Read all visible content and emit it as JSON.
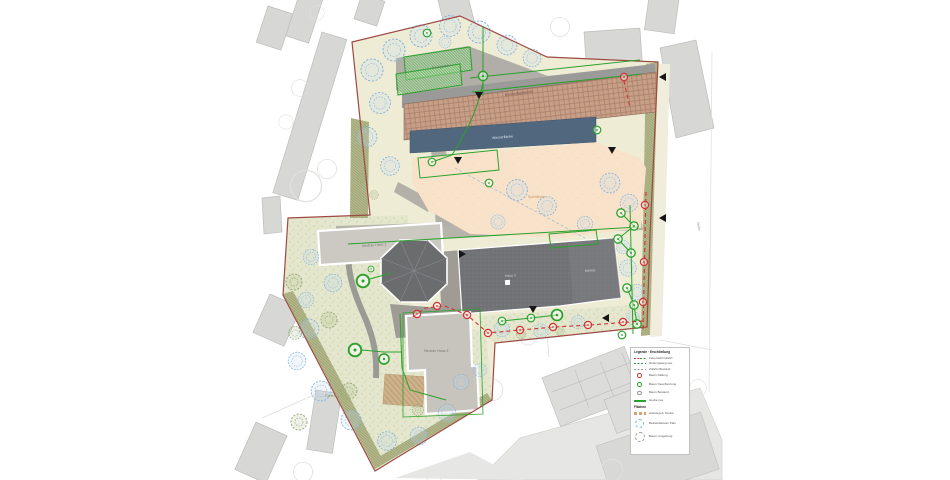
{
  "plan": {
    "labels": {
      "terrace": "Dachgarten",
      "brick_building": "Bestandsgebäude",
      "water": "Wasserfläche",
      "play_area": "Spielfläche",
      "house1": "Neubau Haus 1",
      "house2": "Haus 2",
      "mensa": "Mensa",
      "house3": "Neubau Haus 3",
      "garden": "Garten",
      "street": "Straße"
    }
  },
  "legend": {
    "section1_title": "Legende · Erschließung",
    "section2_title": "Flächen",
    "rows": [
      {
        "swatch": "dash-redgreen",
        "label": "Feuerwehrzufahrt"
      },
      {
        "swatch": "dash-green",
        "label": "Rettungsweg neu"
      },
      {
        "swatch": "dash-gray",
        "label": "Zufahrt Bestand"
      },
      {
        "swatch": "circle-red",
        "label": "Baum Fällung"
      },
      {
        "swatch": "circle-green",
        "label": "Baum Neupflanzung"
      },
      {
        "swatch": "circle-gray",
        "label": "Baum Bestand"
      },
      {
        "swatch": "line-green",
        "label": "Hecke neu"
      },
      {
        "swatch": "dash-tan",
        "label": "wassergeb. Decke"
      },
      {
        "swatch": "tree-blue",
        "label": "Bestandsbaum Plan"
      },
      {
        "swatch": "tree-gray",
        "label": "Baum Umgebung"
      }
    ]
  },
  "colors": {
    "boundary": "#9c4a42",
    "annotation_green": "#2ca12c",
    "annotation_red": "#cf3333",
    "brick_roof": "#c79e86",
    "water_blue": "#50677d",
    "garden_green": "#e4e7ce",
    "peach_play": "#f8e3ca",
    "context_gray": "#d7d7d5"
  }
}
